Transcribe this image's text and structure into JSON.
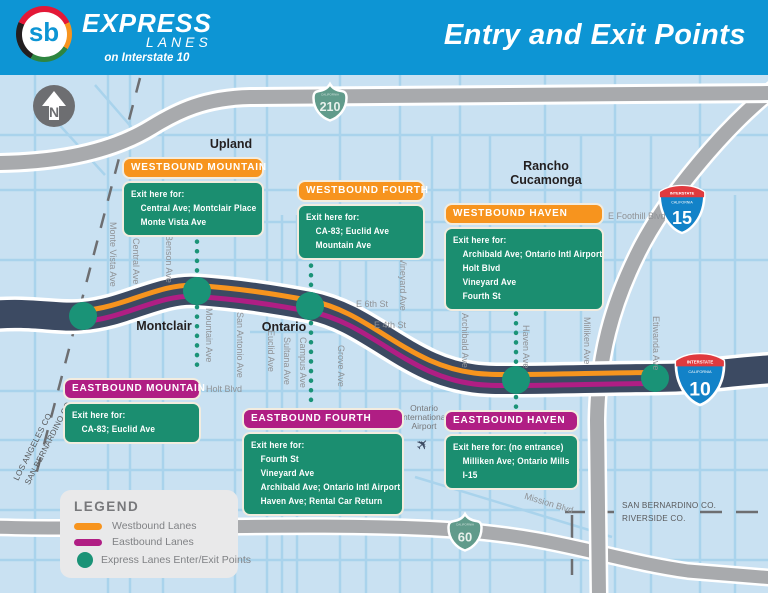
{
  "header": {
    "logo_sb": "sb",
    "logo_express": "EXPRESS",
    "logo_lanes": "LANES",
    "logo_tagline": "on Interstate 10",
    "title": "Entry and Exit Points"
  },
  "colors": {
    "header_blue": "#0d95d4",
    "map_background": "#c9e1f2",
    "freeway_navy": "#3c4a62",
    "road_gray": "#a8aaad",
    "westbound_orange": "#f7941e",
    "eastbound_magenta": "#b01e84",
    "exit_point_green": "#1a9377",
    "callout_green": "#1b8e70"
  },
  "map": {
    "north_label": "N",
    "cities": [
      "Upland",
      "Montclair",
      "Ontario",
      "Rancho",
      "Cucamonga"
    ],
    "vertical_streets": [
      "Monte Vista Ave",
      "Central Ave",
      "Benson Ave",
      "Mountain Ave",
      "San Antonio Ave",
      "Euclid Ave",
      "Sultana Ave",
      "Campus Ave",
      "Grove Ave",
      "Vineyard Ave",
      "Archibald Ave",
      "Haven Ave",
      "Milliken Ave",
      "Etiwanda Ave"
    ],
    "horizontal_streets": [
      "E 6th St",
      "E 4th St",
      "Holt Blvd",
      "E Foothill Blvd",
      "Mission Blvd"
    ],
    "airport": [
      "Ontario",
      "International",
      "Airport"
    ],
    "airplane_icon": "✈",
    "counties": {
      "la": "LOS ANGELES CO.",
      "sb_left": "SAN BERNARDINO CO.",
      "sb_right": "SAN BERNARDINO CO.",
      "riverside": "RIVERSIDE CO."
    },
    "shields": {
      "interstate_word": "INTERSTATE",
      "california_word": "CALIFORNIA",
      "route_210": "210",
      "route_60": "60",
      "i15": "15",
      "i10": "10"
    }
  },
  "callouts": [
    {
      "title": "WESTBOUND MOUNTAIN",
      "direction": "westbound",
      "intro": "Exit here for:",
      "items": [
        "Central Ave; Montclair Place",
        "Monte Vista Ave"
      ]
    },
    {
      "title": "WESTBOUND FOURTH",
      "direction": "westbound",
      "intro": "Exit here for:",
      "items": [
        "CA-83; Euclid Ave",
        "Mountain Ave"
      ]
    },
    {
      "title": "WESTBOUND HAVEN",
      "direction": "westbound",
      "intro": "Exit here for:",
      "items": [
        "Archibald Ave; Ontario Intl Airport",
        "Holt Blvd",
        "Vineyard Ave",
        "Fourth St"
      ]
    },
    {
      "title": "EASTBOUND MOUNTAIN",
      "direction": "eastbound",
      "intro": "Exit here for:",
      "items": [
        "CA-83; Euclid Ave"
      ]
    },
    {
      "title": "EASTBOUND FOURTH",
      "direction": "eastbound",
      "intro": "Exit here for:",
      "items": [
        "Fourth St",
        "Vineyard Ave",
        "Archibald Ave; Ontario Intl Airport",
        "Haven Ave; Rental Car Return"
      ]
    },
    {
      "title": "EASTBOUND HAVEN",
      "direction": "eastbound",
      "intro": "Exit here for: (no entrance)",
      "items": [
        "Milliken Ave; Ontario Mills",
        "I-15"
      ]
    }
  ],
  "legend": {
    "title": "LEGEND",
    "items": [
      {
        "label": "Westbound Lanes"
      },
      {
        "label": "Eastbound Lanes"
      },
      {
        "label": "Express Lanes Enter/Exit Points"
      }
    ]
  }
}
